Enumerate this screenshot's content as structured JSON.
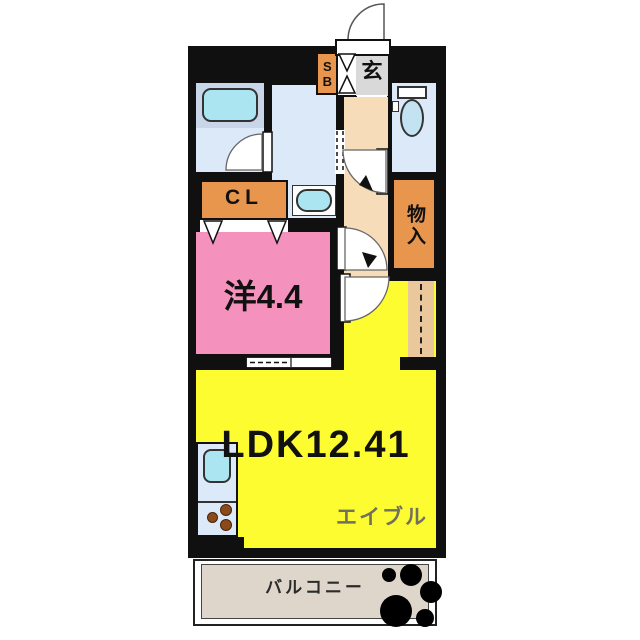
{
  "plan_title": "1LDK apartment floor plan",
  "rooms": {
    "ldk": {
      "label": "LDK12.41"
    },
    "western": {
      "label": "洋4.4"
    },
    "closet": {
      "label": "CL"
    },
    "storage": {
      "label": "物入"
    },
    "entrance": {
      "label": "玄"
    },
    "shoe_box": {
      "label": "SB"
    },
    "balcony": {
      "label": "バルコニー"
    }
  },
  "watermark": {
    "label": "エイブル"
  },
  "colors": {
    "wall": "#101010",
    "water_room": "#dbe9f8",
    "fixture_cyan": "#ace5f2",
    "tub_deck": "#c9d6ea",
    "orange": "#e8954e",
    "hallway": "#f7dcb9",
    "refrigerator_space": "#eac89c",
    "western_room": "#f591bd",
    "ldk_yellow": "#fcfc30",
    "entrance_gray": "#d9d9d9",
    "balcony_beige": "#ded6cb",
    "burner": "#8a4a1a",
    "paw": "#000000",
    "watermark_gray": "#70705e"
  }
}
